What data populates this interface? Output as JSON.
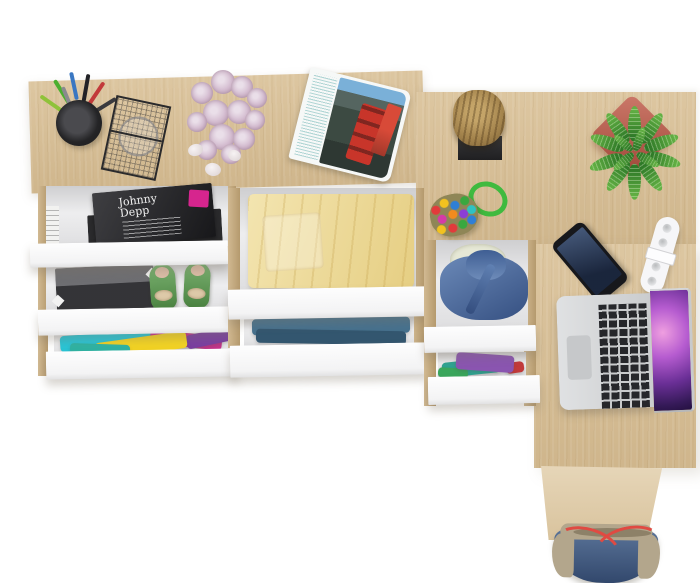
{
  "scene": {
    "description": "Top-down 3D render of an L-shaped light oak desk with white open drawers filled with clothes, magazines and accessories",
    "canvas": {
      "width": 700,
      "height": 583
    }
  },
  "palette": {
    "background": "#ffffff",
    "oak": "#d9c096",
    "oak_light": "#dfcaa4",
    "oak_rail": "#c9ad7f",
    "drawer_front": "#fbfbfc",
    "drawer_interior": "#e6e6e8"
  },
  "furniture": {
    "left_desk": {
      "label": "desk top left section"
    },
    "right_desk": {
      "label": "desk return right section"
    },
    "side_panel": {
      "label": "desk side panel"
    },
    "left_unit": {
      "drawer1": {
        "label": "open drawer with magazines"
      },
      "drawer2": {
        "label": "open drawer with storage box and shoes"
      },
      "drawer3": {
        "label": "open drawer with colorful clothes"
      }
    },
    "middle_unit": {
      "drawer1": {
        "label": "open drawer with yellow towel"
      },
      "drawer2": {
        "label": "open drawer with blue clothes"
      }
    },
    "right_unit": {
      "drawer1": {
        "label": "open drawer with denim jacket"
      },
      "drawer2": {
        "label": "open drawer with purple and teal clothes"
      }
    }
  },
  "objects": {
    "pencil_cup": {
      "label": "black mesh pen cup with pens",
      "cup_color": "#242426",
      "pen_colors": {
        "green": "#4caf2f",
        "blue": "#3a77c2",
        "red": "#c23a3a",
        "black": "#222226",
        "gray": "#8a8a8e",
        "lime": "#8fc23a",
        "dark": "#3a3a3e"
      }
    },
    "wire_basket": {
      "label": "black wire mesh basket with glass",
      "color": "#2a2a2c"
    },
    "roses": {
      "label": "bouquet of pale lilac roses",
      "color": "#d4bcd0"
    },
    "pebbles": {
      "label": "white decorative pebbles",
      "color": "#efe9ea"
    },
    "open_magazine": {
      "label": "open magazine with red double-decker bus photo",
      "bus_color": "#c8352a",
      "bus2_color": "#d84a38",
      "text_color": "#8fc2c2"
    },
    "magazine_stack": {
      "title": "Johnny Depp",
      "label": "magazine stack",
      "cover_color": "#242428",
      "badge_color": "#d6258e"
    },
    "storage_box": {
      "label": "dark grey storage box",
      "color": "#45454a"
    },
    "shoes": {
      "label": "green flats with beige bows",
      "color": "#5a9e4e"
    },
    "clothes_colorful": {
      "colors": {
        "cyan": "#29c5d6",
        "yellow": "#f2d324",
        "magenta": "#c9338f",
        "purple": "#7a3fa0",
        "teal": "#2fb3a3"
      }
    },
    "towel_yellow": {
      "label": "folded yellow towel",
      "color": "#eed98e"
    },
    "clothes_blue": {
      "label": "folded blue clothes",
      "color_top": "#46718e",
      "color_bottom": "#33566f"
    },
    "denim_jacket": {
      "label": "denim jacket with fleece lining",
      "color": "#4a6fa8",
      "lining_color": "#e6e8d6"
    },
    "clothes_purple_teal": {
      "colors": {
        "teal": "#2fa391",
        "purple": "#8a55b0",
        "red": "#c23a3a",
        "green": "#3aa65c"
      }
    },
    "log_stool": {
      "label": "wooden log on black stand",
      "log_color": "#a3834c",
      "base_color": "#2b2b2d"
    },
    "plant": {
      "label": "green plant in red square pot",
      "leaf_color": "#3e8c33",
      "pot_color": "#c05a48"
    },
    "bead_toy": {
      "label": "colorful bead charm with green cord",
      "cord_color": "#3fba3f"
    },
    "smartphone": {
      "label": "black smartphone",
      "body_color": "#17181c",
      "screen_color": "#233250"
    },
    "cable_clip": {
      "label": "white cable organizer clip",
      "color": "#f6f6f8"
    },
    "laptop": {
      "label": "silver laptop with purple galaxy wallpaper",
      "body_color": "#d5d7d9",
      "screen_accent": "#8b3fa8"
    },
    "bag": {
      "label": "blue canvas tote bag with red straps",
      "color": "#43608a",
      "trim_color": "#b3a68c",
      "strap_color": "#e04a42"
    }
  }
}
